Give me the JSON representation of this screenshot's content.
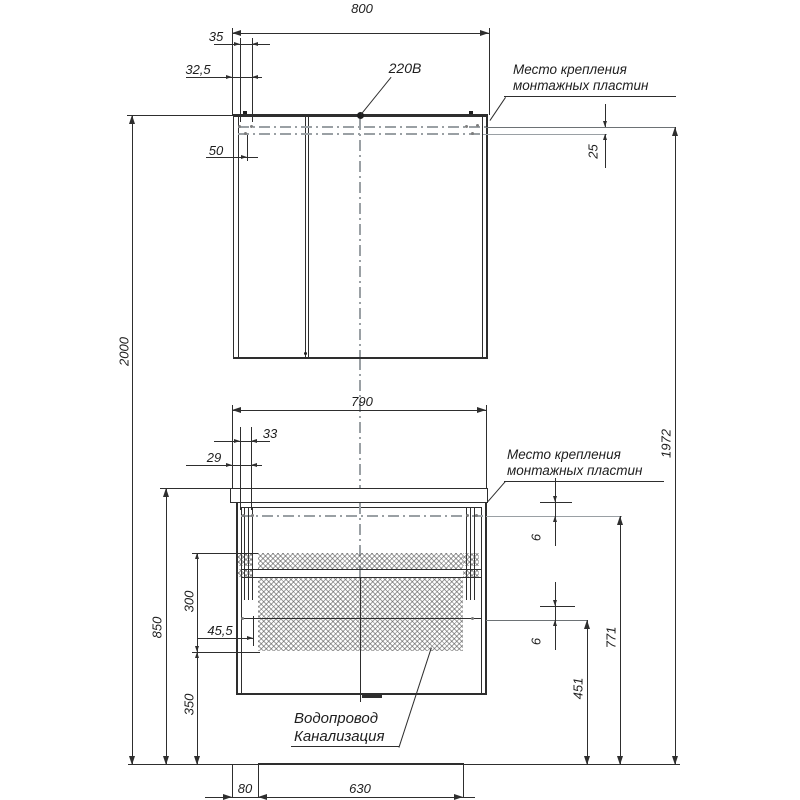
{
  "mirror_cabinet": {
    "width": "800",
    "offset_a": "35",
    "offset_b": "32,5",
    "offset_c": "50",
    "power": "220В",
    "mount_line1": "Место крепления",
    "mount_line2": "монтажных пластин",
    "plate_gap": "25"
  },
  "vanity": {
    "width": "790",
    "offset_a": "33",
    "offset_b": "29",
    "offset_c": "45,5",
    "mount_line1": "Место крепления",
    "mount_line2": "монтажных пластин",
    "gap_top": "6",
    "gap_bottom": "6",
    "utility_line1": "Водопровод",
    "utility_line2": "Канализация",
    "bottom_offset": "80",
    "utility_zone_width": "630"
  },
  "heights": {
    "total": "2000",
    "mirror_mount": "1972",
    "vanity_top": "850",
    "drawer_zone": "300",
    "clearance": "350",
    "mount_upper": "771",
    "mount_lower": "451"
  }
}
